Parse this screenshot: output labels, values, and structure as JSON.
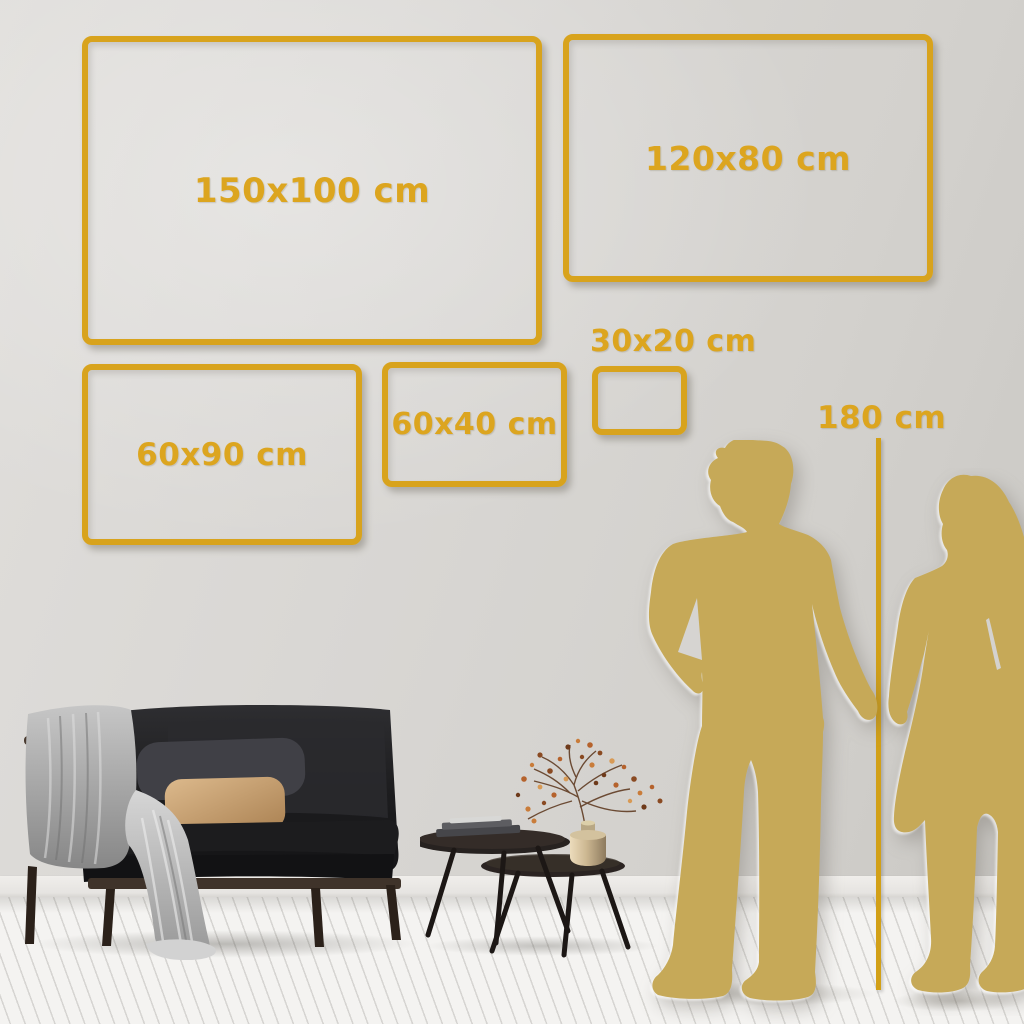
{
  "page": {
    "type": "canvas-print-size-guide"
  },
  "colors": {
    "accent_gold": "#D8A31D",
    "label_gold": "#DCA51F",
    "silhouette_gold": "#C6A958",
    "wall": "#D7D5D2",
    "floor": "#F4F3F1"
  },
  "size_frames": [
    {
      "label": "150x100 cm",
      "width_cm": 150,
      "height_cm": 100
    },
    {
      "label": "120x80 cm",
      "width_cm": 120,
      "height_cm": 80
    },
    {
      "label": "60x90 cm",
      "width_cm": 60,
      "height_cm": 90
    },
    {
      "label": "60x40 cm",
      "width_cm": 60,
      "height_cm": 40
    },
    {
      "label": "30x20 cm",
      "width_cm": 30,
      "height_cm": 20
    }
  ],
  "height_reference": {
    "label": "180 cm",
    "value_cm": 180
  },
  "scene": {
    "figures": [
      "man-silhouette",
      "woman-silhouette"
    ],
    "furniture": [
      "sofa",
      "coffee-tables",
      "vase-plant"
    ]
  }
}
